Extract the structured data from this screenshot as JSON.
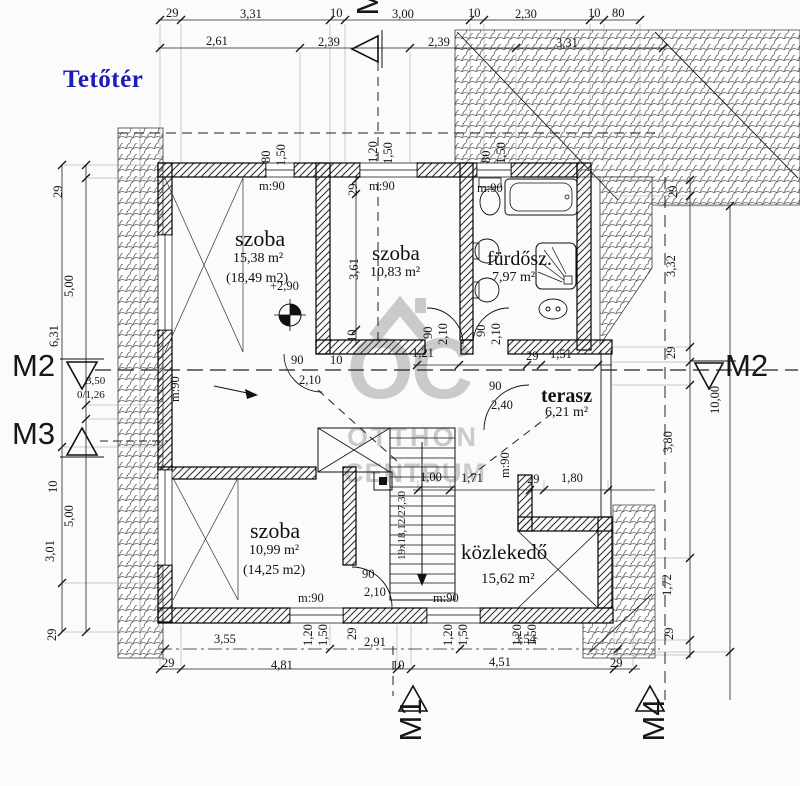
{
  "title": "Tetőtér",
  "watermark": {
    "logo": "OC",
    "line1": "OTTHON",
    "line2": "CENTRUM"
  },
  "markers": {
    "top": "M1",
    "left_upper": "M2",
    "left_lower": "M3",
    "right": "M2",
    "bottom_center": "M1",
    "bottom_right": "M4"
  },
  "rooms": {
    "szoba1": {
      "name": "szoba",
      "area": "15,38 m²",
      "area_alt": "(18,49 m2)"
    },
    "szoba2": {
      "name": "szoba",
      "area": "10,83 m²"
    },
    "furdo": {
      "name": "fürdősz.",
      "area": "7,97 m²"
    },
    "terasz": {
      "name": "terasz",
      "area": "6,21 m²"
    },
    "szoba3": {
      "name": "szoba",
      "area": "10,99 m²",
      "area_alt": "(14,25 m2)"
    },
    "kozlekedo": {
      "name": "közlekedő",
      "area": "15,62 m²"
    }
  },
  "level_mark": "+2,90",
  "accent_color": "#1c1cb8",
  "watermark_color": "#adadad",
  "annotations": [
    {
      "t": "29",
      "x": 166,
      "y": 7
    },
    {
      "t": "3,31",
      "x": 240,
      "y": 8
    },
    {
      "t": "10",
      "x": 330,
      "y": 7
    },
    {
      "t": "3,00",
      "x": 392,
      "y": 8
    },
    {
      "t": "10",
      "x": 468,
      "y": 7
    },
    {
      "t": "2,30",
      "x": 515,
      "y": 8
    },
    {
      "t": "10",
      "x": 588,
      "y": 7
    },
    {
      "t": "80",
      "x": 612,
      "y": 7
    },
    {
      "t": "2,61",
      "x": 206,
      "y": 35
    },
    {
      "t": "2,39",
      "x": 318,
      "y": 36
    },
    {
      "t": "2,39",
      "x": 428,
      "y": 36
    },
    {
      "t": "3,31",
      "x": 556,
      "y": 37
    },
    {
      "t": "3,50",
      "x": 86,
      "y": 376,
      "s": 1
    },
    {
      "t": "0/1,26",
      "x": 77,
      "y": 390,
      "s": 1
    },
    {
      "t": "3,55",
      "x": 214,
      "y": 633
    },
    {
      "t": "2,91",
      "x": 364,
      "y": 636
    },
    {
      "t": "3,54",
      "x": 514,
      "y": 633
    },
    {
      "t": "29",
      "x": 162,
      "y": 657
    },
    {
      "t": "4,81",
      "x": 271,
      "y": 659
    },
    {
      "t": "10",
      "x": 392,
      "y": 659
    },
    {
      "t": "4,51",
      "x": 489,
      "y": 656
    },
    {
      "t": "29",
      "x": 610,
      "y": 657
    },
    {
      "t": "1,00",
      "x": 420,
      "y": 471
    },
    {
      "t": "1,71",
      "x": 461,
      "y": 472
    },
    {
      "t": "29",
      "x": 527,
      "y": 473
    },
    {
      "t": "1,80",
      "x": 561,
      "y": 472
    },
    {
      "t": "1,21",
      "x": 412,
      "y": 347
    },
    {
      "t": "29",
      "x": 526,
      "y": 350
    },
    {
      "t": "1,51",
      "x": 550,
      "y": 348
    },
    {
      "t": "90",
      "x": 291,
      "y": 354
    },
    {
      "t": "2,10",
      "x": 299,
      "y": 374
    },
    {
      "t": "10",
      "x": 330,
      "y": 354
    },
    {
      "t": "90",
      "x": 489,
      "y": 380
    },
    {
      "t": "2,40",
      "x": 491,
      "y": 399
    },
    {
      "t": "90",
      "x": 362,
      "y": 568
    },
    {
      "t": "2,10",
      "x": 364,
      "y": 586
    },
    {
      "t": "m:90",
      "x": 259,
      "y": 180
    },
    {
      "t": "m:90",
      "x": 369,
      "y": 180
    },
    {
      "t": "m:90",
      "x": 477,
      "y": 182
    },
    {
      "t": "m:90",
      "x": 298,
      "y": 592
    },
    {
      "t": "m:90",
      "x": 433,
      "y": 592
    },
    {
      "t": "+2,90",
      "x": 270,
      "y": 280
    },
    {
      "t": "6,31",
      "x": 48,
      "y": 347,
      "r": 1
    },
    {
      "t": "3,01",
      "x": 44,
      "y": 562,
      "r": 1
    },
    {
      "t": "29",
      "x": 52,
      "y": 198,
      "r": 1
    },
    {
      "t": "5,00",
      "x": 63,
      "y": 297,
      "r": 1
    },
    {
      "t": "10",
      "x": 47,
      "y": 493,
      "r": 1
    },
    {
      "t": "5,00",
      "x": 63,
      "y": 527,
      "r": 1
    },
    {
      "t": "29",
      "x": 46,
      "y": 641,
      "r": 1
    },
    {
      "t": "29",
      "x": 667,
      "y": 198,
      "r": 1
    },
    {
      "t": "3,32",
      "x": 665,
      "y": 277,
      "r": 1
    },
    {
      "t": "29",
      "x": 665,
      "y": 359,
      "r": 1
    },
    {
      "t": "3,80",
      "x": 662,
      "y": 453,
      "r": 1
    },
    {
      "t": "1,72",
      "x": 661,
      "y": 596,
      "r": 1
    },
    {
      "t": "29",
      "x": 663,
      "y": 640,
      "r": 1
    },
    {
      "t": "10,00",
      "x": 709,
      "y": 414,
      "r": 1
    },
    {
      "t": "29",
      "x": 347,
      "y": 196,
      "r": 1
    },
    {
      "t": "3,61",
      "x": 348,
      "y": 280,
      "r": 1
    },
    {
      "t": "10",
      "x": 346,
      "y": 342,
      "r": 1
    },
    {
      "t": "80",
      "x": 260,
      "y": 163,
      "r": 1
    },
    {
      "t": "1,50",
      "x": 275,
      "y": 166,
      "r": 1
    },
    {
      "t": "1,20",
      "x": 367,
      "y": 163,
      "r": 1
    },
    {
      "t": "1,50",
      "x": 382,
      "y": 164,
      "r": 1
    },
    {
      "t": "80",
      "x": 480,
      "y": 163,
      "r": 1
    },
    {
      "t": "1,50",
      "x": 495,
      "y": 164,
      "r": 1
    },
    {
      "t": "90",
      "x": 422,
      "y": 339,
      "r": 1
    },
    {
      "t": "2,10",
      "x": 437,
      "y": 345,
      "r": 1
    },
    {
      "t": "90",
      "x": 475,
      "y": 337,
      "r": 1
    },
    {
      "t": "2,10",
      "x": 490,
      "y": 345,
      "r": 1
    },
    {
      "t": "m:90",
      "x": 169,
      "y": 402,
      "r": 1
    },
    {
      "t": "m:90",
      "x": 499,
      "y": 478,
      "r": 1
    },
    {
      "t": "1,20",
      "x": 302,
      "y": 646,
      "r": 1
    },
    {
      "t": "1,50",
      "x": 317,
      "y": 646,
      "r": 1
    },
    {
      "t": "29",
      "x": 346,
      "y": 640,
      "r": 1
    },
    {
      "t": "1,20",
      "x": 442,
      "y": 646,
      "r": 1
    },
    {
      "t": "1,50",
      "x": 457,
      "y": 646,
      "r": 1
    },
    {
      "t": "1,20",
      "x": 511,
      "y": 646,
      "r": 1
    },
    {
      "t": "1,50",
      "x": 526,
      "y": 646,
      "r": 1
    },
    {
      "t": "19x18,12/27,30",
      "x": 397,
      "y": 560,
      "r": 1,
      "s": 1
    }
  ]
}
